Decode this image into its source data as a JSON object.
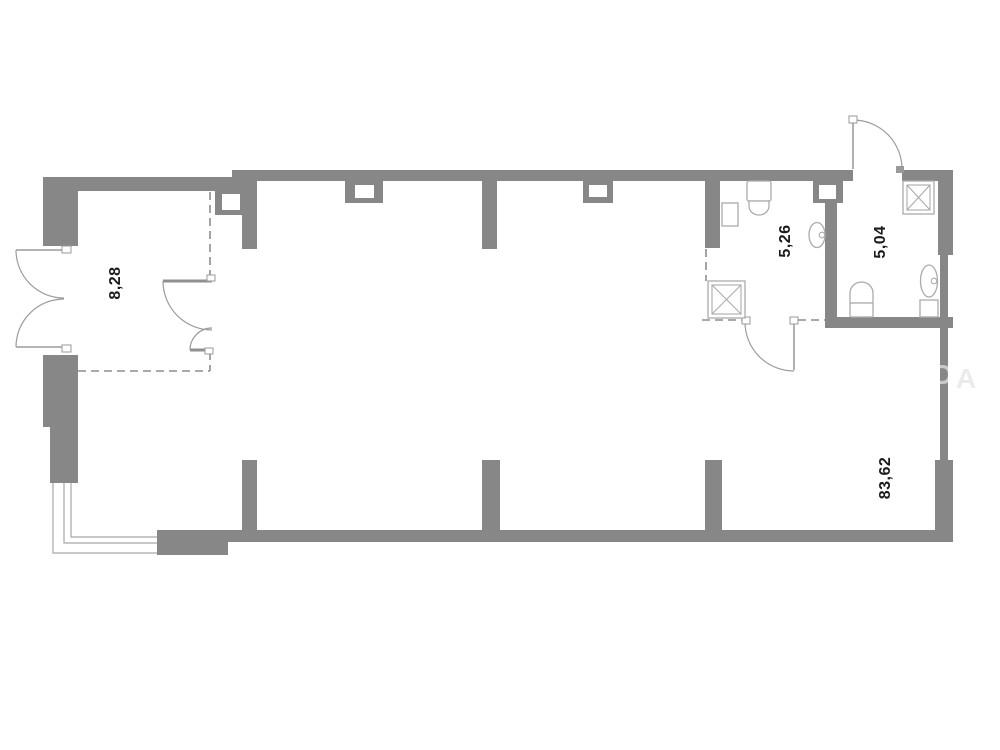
{
  "plan": {
    "title": "apartment-floor-plan",
    "rooms": [
      {
        "id": "entry-room",
        "area_label": "8,28"
      },
      {
        "id": "bathroom-left",
        "area_label": "5,26"
      },
      {
        "id": "bathroom-right",
        "area_label": "5,04"
      },
      {
        "id": "main-space",
        "area_label": "83,62"
      }
    ],
    "watermark": {
      "letter_d": "D",
      "letter_a": "A"
    },
    "colors": {
      "wall": "#878787",
      "dashed_line": "#8d8d8d",
      "door_swing": "#9c9c9c",
      "fixture_outline": "#ababab",
      "label_text": "#1c1c1c",
      "background": "#ffffff"
    }
  }
}
